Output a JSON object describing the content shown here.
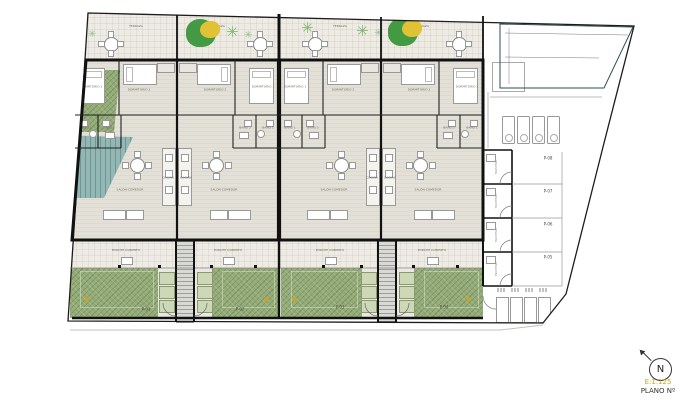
{
  "title_block": {
    "north": "N",
    "scale": "E:1.125",
    "plan_no": "PLANO Nº"
  },
  "plan": {
    "units": [
      {
        "terrace": "TERRAZA",
        "bed1": "DORMITORIO 1",
        "bed2": "DORMITORIO 2",
        "bath1": "BAÑO 1",
        "bath2": "BAÑO 2",
        "kitchen": "COCINA",
        "living": "SALÓN-COMEDOR",
        "porch": "PORCHE CUBIERTO"
      },
      {
        "terrace": "TERRAZA",
        "bed1": "DORMITORIO 1",
        "bed2": "DORMITORIO 2",
        "bath1": "BAÑO 1",
        "bath2": "BAÑO 2",
        "kitchen": "COCINA",
        "living": "SALÓN-COMEDOR",
        "porch": "PORCHE CUBIERTO"
      },
      {
        "terrace": "TERRAZA",
        "bed1": "DORMITORIO 1",
        "bed2": "DORMITORIO 2",
        "bath1": "BAÑO 1",
        "bath2": "BAÑO 2",
        "kitchen": "COCINA",
        "living": "SALÓN-COMEDOR",
        "porch": "PORCHE CUBIERTO"
      },
      {
        "terrace": "TERRAZA",
        "bed1": "DORMITORIO 1",
        "bed2": "DORMITORIO 2",
        "bath1": "BAÑO 1",
        "bath2": "BAÑO 2",
        "kitchen": "COCINA",
        "living": "SALÓN-COMEDOR",
        "porch": "PORCHE CUBIERTO"
      }
    ],
    "gardens": [
      {
        "label": "P-01"
      },
      {
        "label": "P-02"
      },
      {
        "label": "P-03"
      },
      {
        "label": "P-04"
      }
    ],
    "parking_spaces": [
      {
        "label": "P-08"
      },
      {
        "label": "P-07"
      },
      {
        "label": "P-06"
      },
      {
        "label": "P-05"
      }
    ],
    "storage_label": "TRASTERO"
  },
  "colors": {
    "garden_green": "#93ab76",
    "pool_teal": "#92b7b4",
    "planter_green": "#cdd8b7",
    "wall_black": "#111111",
    "scale_accent": "#d9a21b"
  }
}
